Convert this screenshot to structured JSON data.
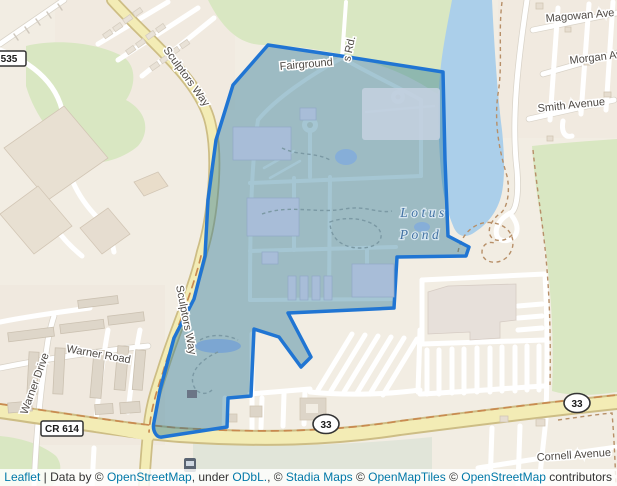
{
  "map": {
    "region_label": {
      "line1": "Lotus",
      "line2": "Pond"
    },
    "street_labels": {
      "sculptors_way": "Sculptors Way",
      "fairgrounds_rd_part1": "Fairground",
      "fairgrounds_rd_part2": "s Rd.",
      "magowan_ave": "Magowan Ave",
      "morgan_ave": "Morgan Ave",
      "smith_avenue": "Smith Avenue",
      "warner_road": "Warner Road",
      "warner_drive": "Warner Drive",
      "cornell_avenue": "Cornell Avenue"
    },
    "route_shields": {
      "cr535": "535",
      "cr614": "CR 614",
      "route33": "33"
    },
    "colors": {
      "land": "#f2ede3",
      "green_area": "#d9e7c2",
      "water": "#abcfea",
      "road_yellow": "#f3ecb5",
      "road_casing": "#cdbd85",
      "overlay_fill": "rgba(40,120,150,0.42)",
      "overlay_stroke": "#2075d3",
      "water_label_color": "#4272a3",
      "link_color": "#0078a8"
    }
  },
  "attribution": {
    "segments": [
      {
        "text": "Leaflet",
        "link": true
      },
      {
        "text": " | Data by © ",
        "link": false
      },
      {
        "text": "OpenStreetMap",
        "link": true
      },
      {
        "text": ", under ",
        "link": false
      },
      {
        "text": "ODbL.",
        "link": true
      },
      {
        "text": ", © ",
        "link": false
      },
      {
        "text": "Stadia Maps",
        "link": true
      },
      {
        "text": " © ",
        "link": false
      },
      {
        "text": "OpenMapTiles",
        "link": true
      },
      {
        "text": " © ",
        "link": false
      },
      {
        "text": "OpenStreetMap",
        "link": true
      },
      {
        "text": " contributors",
        "link": false
      }
    ]
  }
}
